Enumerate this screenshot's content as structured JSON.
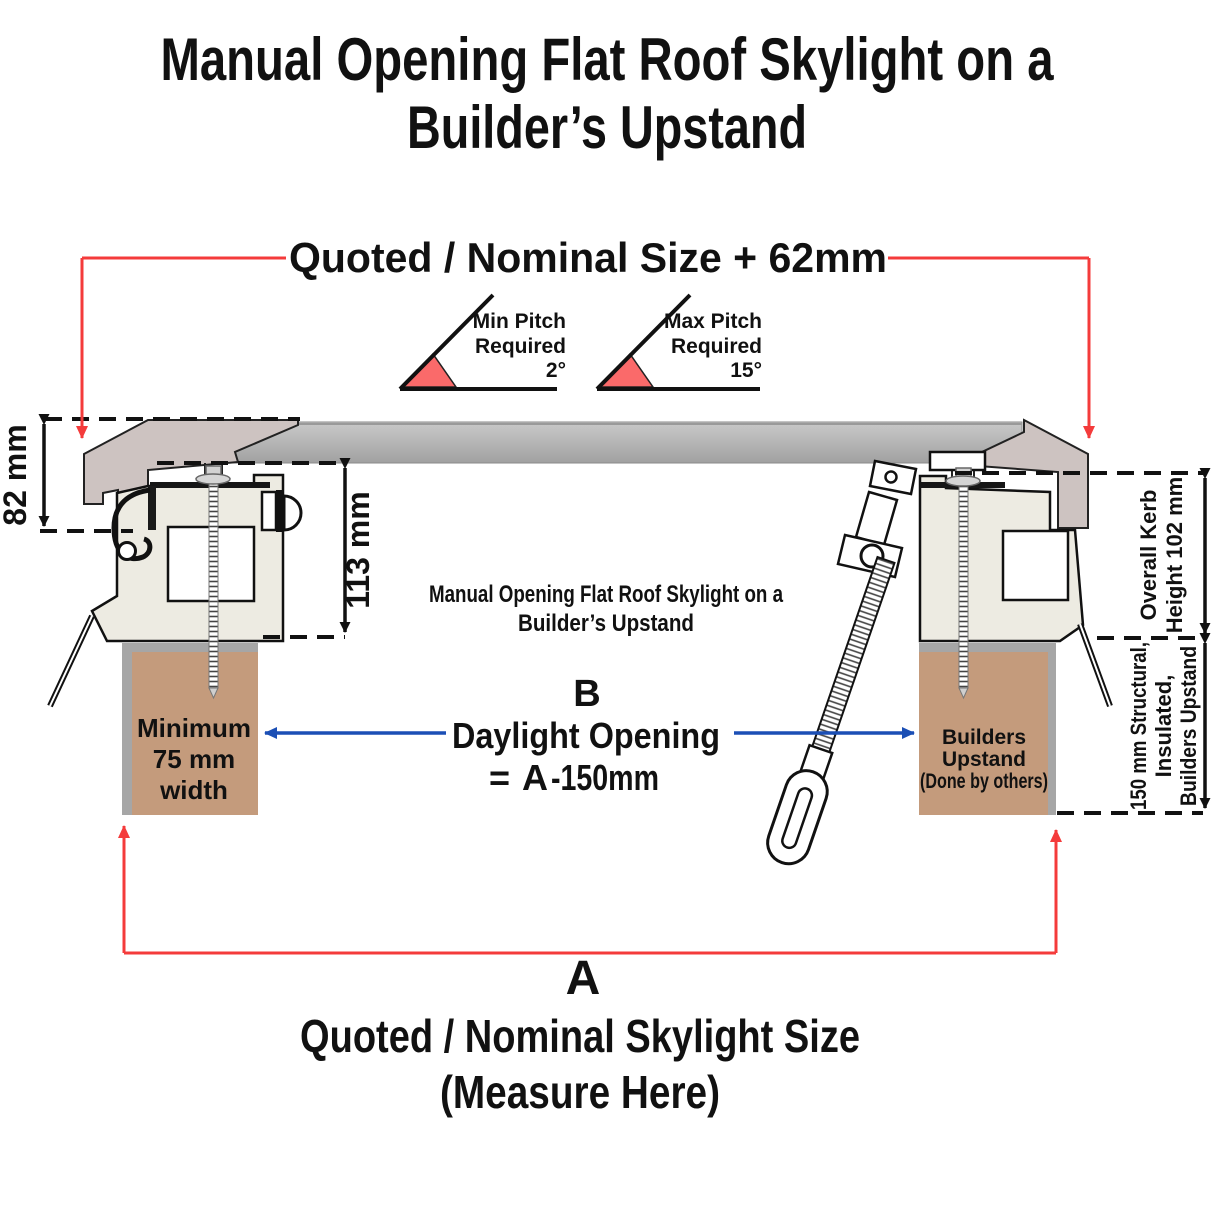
{
  "title": {
    "line1": "Manual Opening Flat Roof Skylight on a",
    "line2": "Builder’s Upstand"
  },
  "top_dimension": {
    "label": "Quoted / Nominal Size + 62mm"
  },
  "pitch": {
    "min": {
      "line1": "Min Pitch",
      "line2": "Required",
      "value": "2°"
    },
    "max": {
      "line1": "Max Pitch",
      "line2": "Required",
      "value": "15°"
    }
  },
  "side_dimensions": {
    "frame_height": "82 mm",
    "kerb_frame_height": "113 mm",
    "overall_kerb": {
      "line1": "Overall Kerb",
      "line2": "Height 102 mm"
    },
    "structural": {
      "line1": "150 mm Structural,",
      "line2": "Insulated,",
      "line3": "Builders Upstand"
    }
  },
  "center_label": {
    "line1": "Manual Opening Flat Roof Skylight on a",
    "line2": "Builder’s Upstand"
  },
  "daylight": {
    "letter": "B",
    "label": "Daylight Opening",
    "eq": "=",
    "a": "A",
    "rest": "-150mm"
  },
  "upstand_left": {
    "line1": "Minimum",
    "line2": "75 mm",
    "line3": "width"
  },
  "upstand_right": {
    "line1": "Builders",
    "line2": "Upstand",
    "line3": "(Done by others)"
  },
  "bottom_dimension": {
    "letter": "A",
    "line1": "Quoted / Nominal Skylight Size",
    "line2": "(Measure Here)"
  },
  "colors": {
    "red": "#f43b3b",
    "blue_text": "#17489e",
    "blue_line": "#1b4fb5",
    "wedge": "#fa6a6a",
    "brown": "#c49b7c",
    "glass_top": "#c6c6c6",
    "glass_bottom": "#a2a2a2",
    "cap": "#cdc3c1",
    "frame": "#edebe2",
    "flashing": "#a6a6a6"
  }
}
